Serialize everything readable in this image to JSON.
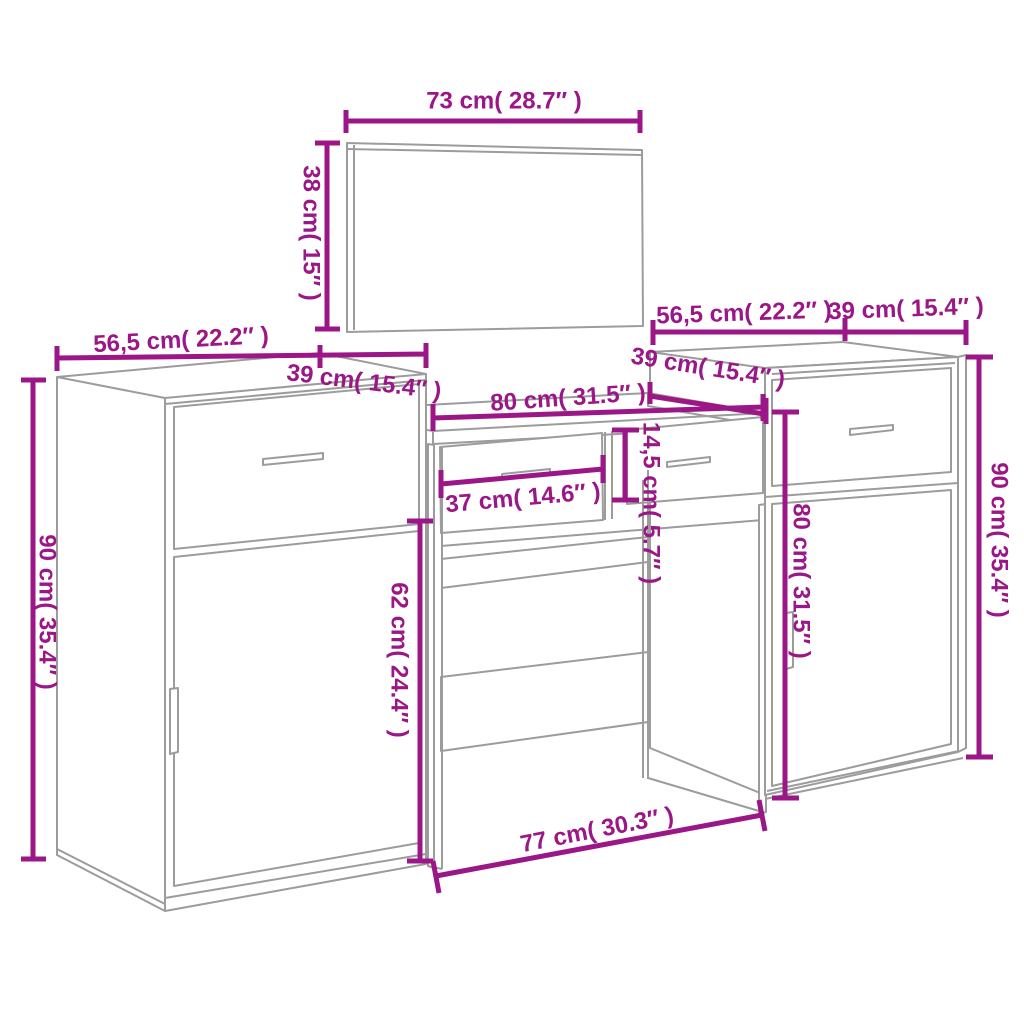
{
  "colors": {
    "dimension_accent": "#9B1687",
    "furniture_line": "#9C9C9C",
    "background": "#FFFFFF"
  },
  "pieces": {
    "mirror": {
      "width_label": "73 cm( 28.7″ )",
      "height_label": "38 cm( 15″ )"
    },
    "left_cabinet": {
      "width_label": "56,5 cm( 22.2″ )",
      "depth_label": "39 cm( 15.4″ )",
      "height_label": "90 cm( 35.4″ )"
    },
    "dressing_table": {
      "width_label": "80 cm( 31.5″ )",
      "drawer_width_label": "37 cm( 14.6″ )",
      "drawer_height_label": "14,5 cm( 5.7″ )",
      "depth_label": "39 cm( 15.4″ )",
      "leg_height_label": "62 cm( 24.4″ )",
      "base_width_label": "77 cm( 30.3″ )"
    },
    "right_cabinet": {
      "width_label": "56,5 cm( 22.2″ )",
      "depth_label": "39 cm( 15.4″ )",
      "front_height_label": "80 cm( 31.5″ )",
      "height_label": "90 cm( 35.4″ )"
    }
  }
}
